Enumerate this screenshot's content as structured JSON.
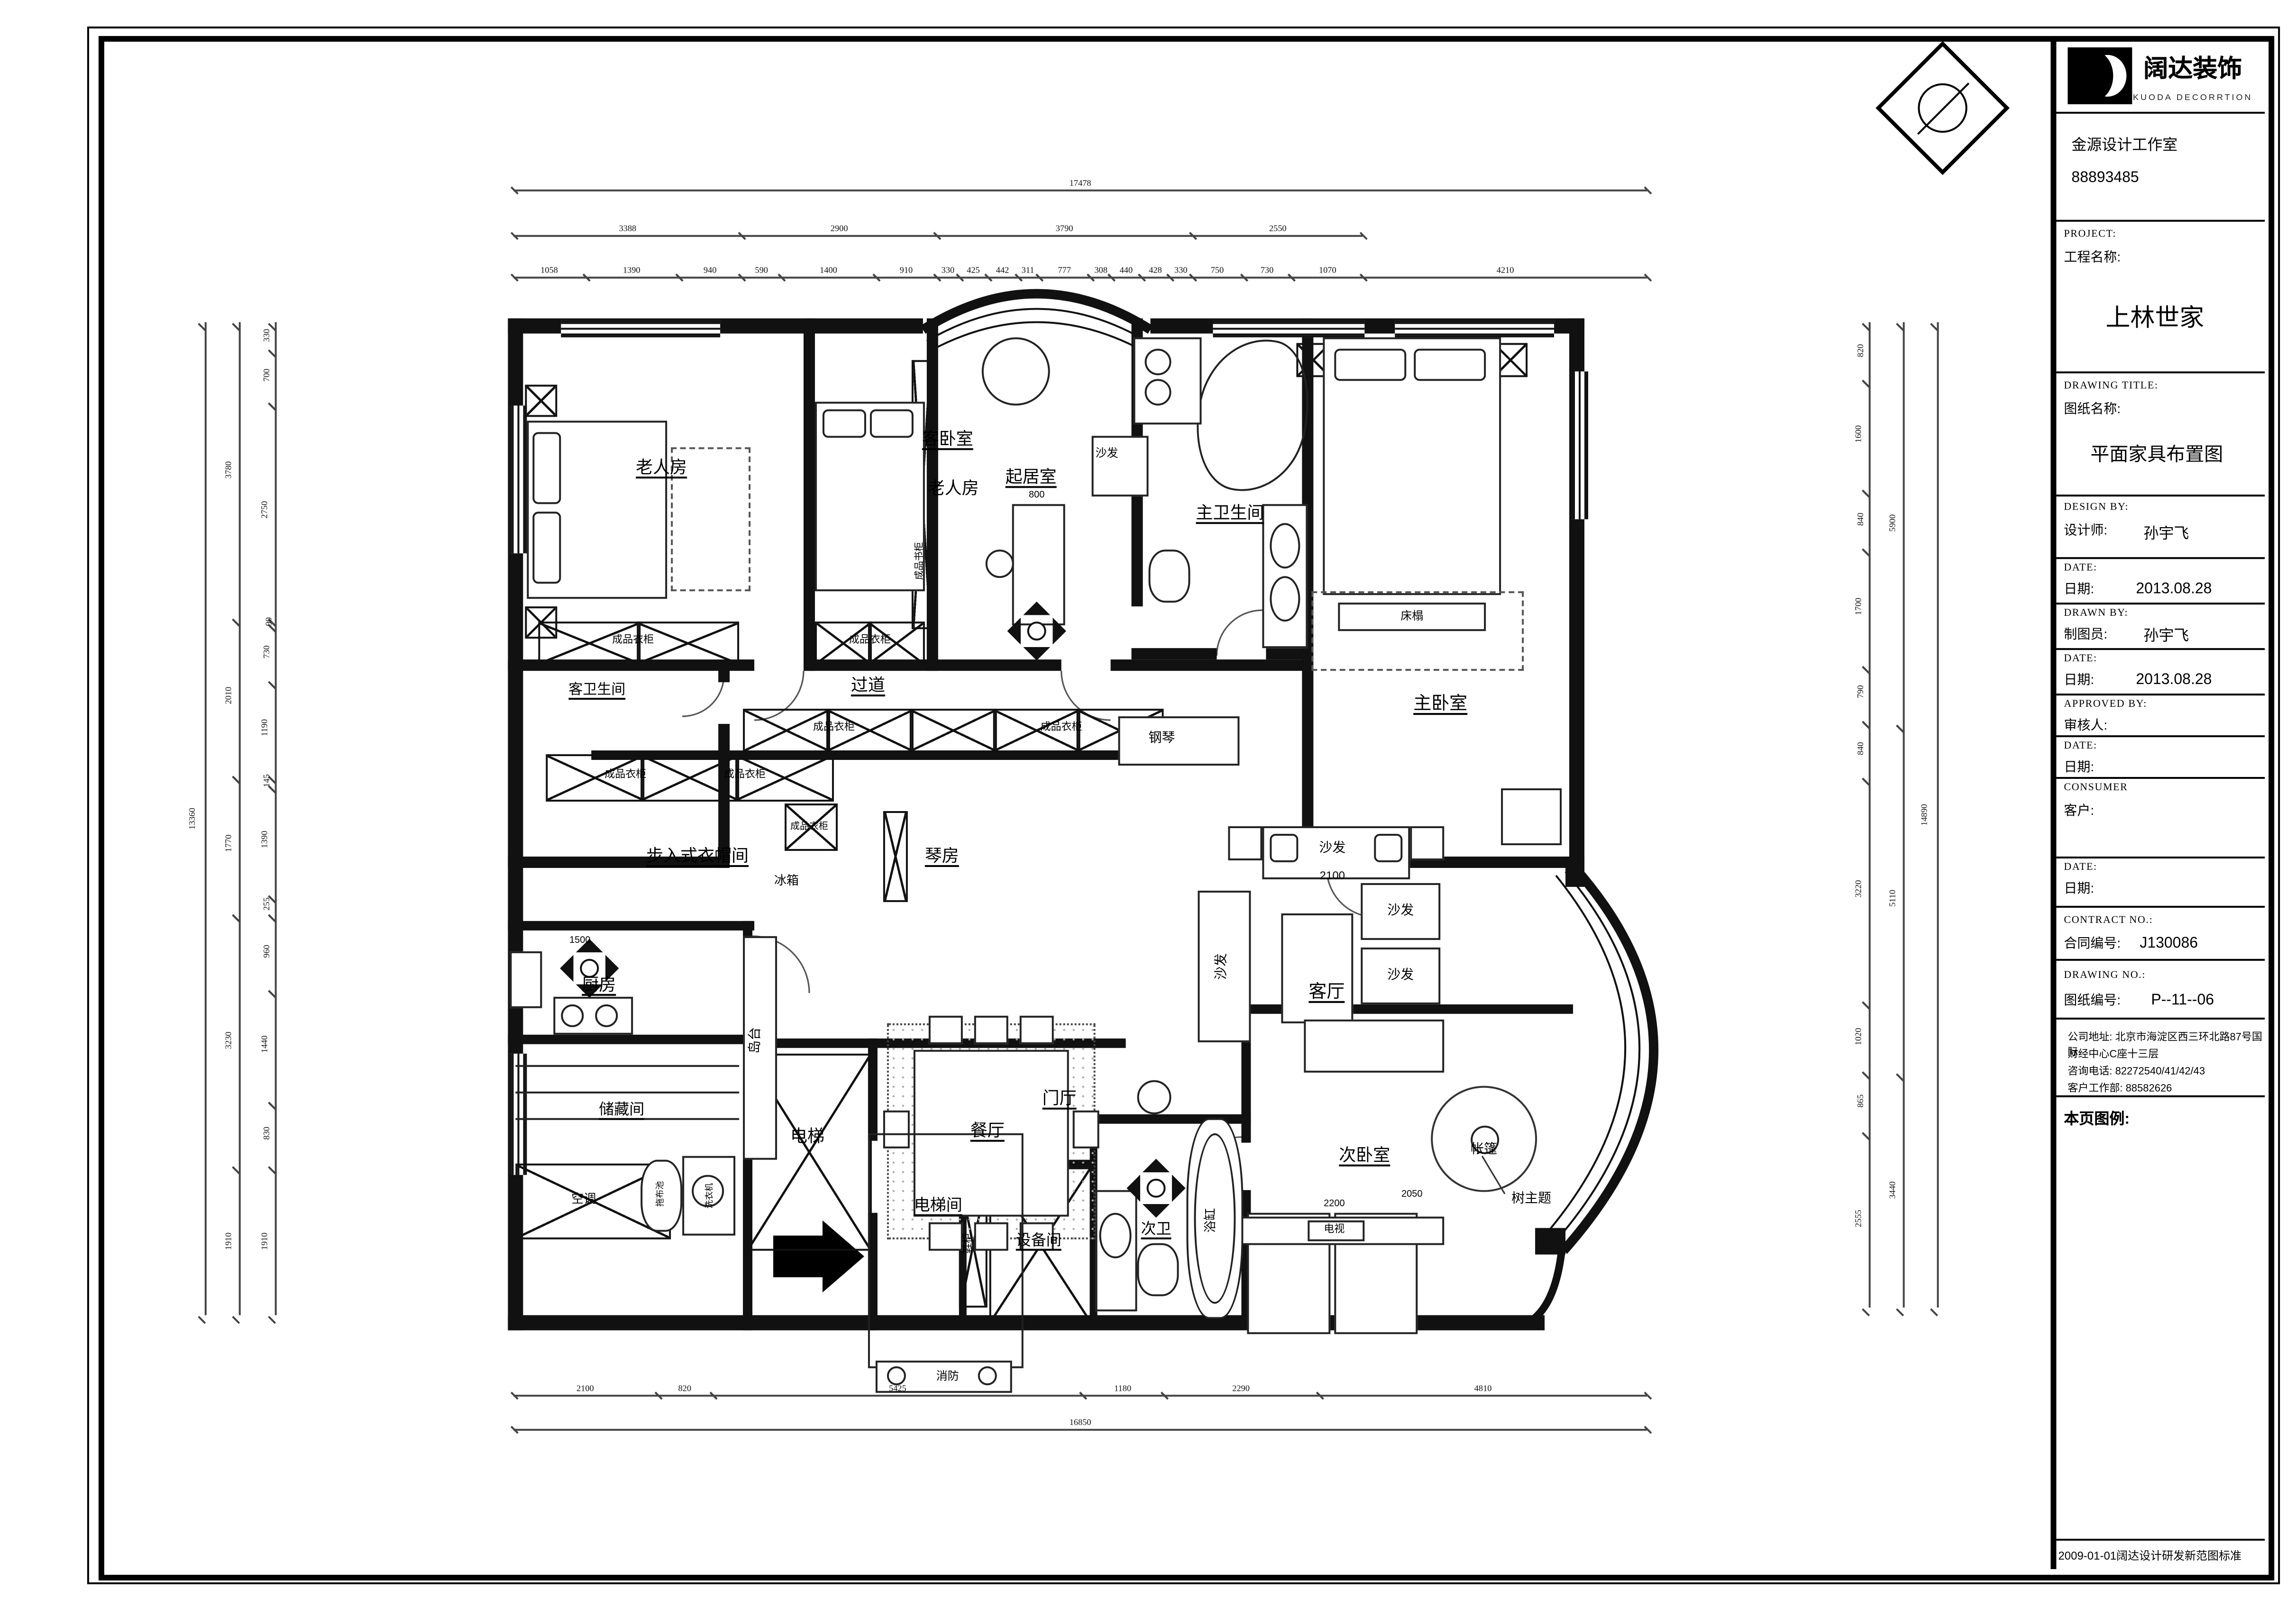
{
  "title_block": {
    "logo_cn": "阔达装饰",
    "logo_en": "KUODA DECORRTION",
    "studio": "金源设计工作室",
    "studio_phone": "88893485",
    "project_label_en": "PROJECT:",
    "project_label_cn": "工程名称:",
    "project_name": "上林世家",
    "drawing_title_label_en": "DRAWING TITLE:",
    "drawing_title_label_cn": "图纸名称:",
    "drawing_title": "平面家具布置图",
    "design_by_en": "DESIGN BY:",
    "design_by_cn": "设计师:",
    "designer": "孙宇飞",
    "date1_en": "DATE:",
    "date1_cn": "日期:",
    "date1": "2013.08.28",
    "drawn_by_en": "DRAWN BY:",
    "drawn_by_cn": "制图员:",
    "drafter": "孙宇飞",
    "date2_en": "DATE:",
    "date2_cn": "日期:",
    "date2": "2013.08.28",
    "approved_by_en": "APPROVED BY:",
    "approved_by_cn": "审核人:",
    "date3_en": "DATE:",
    "date3_cn": "日期:",
    "consumer_en": "CONSUMER",
    "consumer_cn": "客户:",
    "date4_en": "DATE:",
    "date4_cn": "日期:",
    "contract_en": "CONTRACT NO.:",
    "contract_cn": "合同编号:",
    "contract_no": "J130086",
    "drawing_no_en": "DRAWING NO.:",
    "drawing_no_cn": "图纸编号:",
    "drawing_no": "P--11--06",
    "company_address_l1": "公司地址: 北京市海淀区西三环北路87号国际",
    "company_address_l2": "财经中心C座十三层",
    "company_phone": "咨询电话: 82272540/41/42/43",
    "company_service": "客户工作部: 88582626",
    "legend_label": "本页图例:",
    "footer_note": "2009-01-01阔达设计研发新范图标准"
  },
  "plan": {
    "labels": {
      "elder_room": "老人房",
      "guest_room_1": "客卧室",
      "guest_room_2": "老人房",
      "sitting_room": "起居室",
      "sitting_sofa": "沙发",
      "master_bath": "主卫生间",
      "master_bedroom": "主卧室",
      "bed_bench": "床榻",
      "guest_bath": "客卫生间",
      "corridor": "过道",
      "corridor_cab1": "成品衣柜",
      "corridor_cab2": "成品衣柜",
      "closet_cab1": "成品衣柜",
      "closet_cab2": "成品衣柜",
      "closet_cab3": "成品衣柜",
      "elder_cab": "成品衣柜",
      "guest_cab": "成品衣柜",
      "bookcase": "成品书柜",
      "walkin_closet": "步入式衣帽间",
      "piano_room": "琴房",
      "fridge": "冰箱",
      "grand_piano": "钢琴",
      "kitchen": "厨房",
      "island": "岛台",
      "dining": "餐厅",
      "living": "客厅",
      "sofa_top": "沙发",
      "sofa_dim": "2100",
      "sofa_left": "沙发",
      "sofa_r1": "沙发",
      "sofa_r2": "沙发",
      "tv": "电视",
      "storage": "储藏间",
      "ac": "空调",
      "mop_sink": "拖布池",
      "washer": "洗衣机",
      "elevator": "电梯",
      "elevator_hall": "电梯间",
      "fire": "消防",
      "shoe_cab": "鞋柜",
      "equipment": "设备间",
      "foyer": "门厅",
      "sec_bath": "次卫",
      "bathtub": "浴缸",
      "sec_bedroom": "次卧室",
      "tent": "帐篷",
      "tree_theme": "树主题",
      "dim_2050": "2050",
      "dim_1500": "1500",
      "dim_800": "800",
      "dim_2200": "2200"
    },
    "dims": {
      "top": {
        "overall": "17478",
        "row2": [
          "3388",
          "2900",
          "3790",
          "2550"
        ],
        "row3": [
          [
            "1058",
            "1390",
            "940"
          ],
          [
            "590",
            "1400",
            "910"
          ],
          [
            "330",
            "425",
            "442",
            "311",
            "777",
            "308",
            "440",
            "428",
            "330"
          ],
          [
            "750",
            "730",
            "1070"
          ],
          [
            "4210"
          ]
        ]
      },
      "bottom": {
        "overall": "16850",
        "row": [
          "2100",
          "820",
          "5425",
          "1180",
          "2290",
          "4810"
        ]
      },
      "left": {
        "overall": "13360",
        "outer": [
          "3780",
          "2010",
          "1770",
          "3230",
          "1910"
        ],
        "inner": [
          "330",
          "700",
          "2750",
          "90",
          "730",
          "1190",
          "145",
          "1390",
          "255",
          "960",
          "1440",
          "830",
          "1910"
        ]
      },
      "right": {
        "overall": "14890",
        "mid": [
          "5900",
          "5110",
          "3440"
        ],
        "inner": [
          "820",
          "1600",
          "840",
          "1700",
          "790",
          "840",
          "3220",
          "1020",
          "865",
          "2555"
        ]
      }
    }
  }
}
